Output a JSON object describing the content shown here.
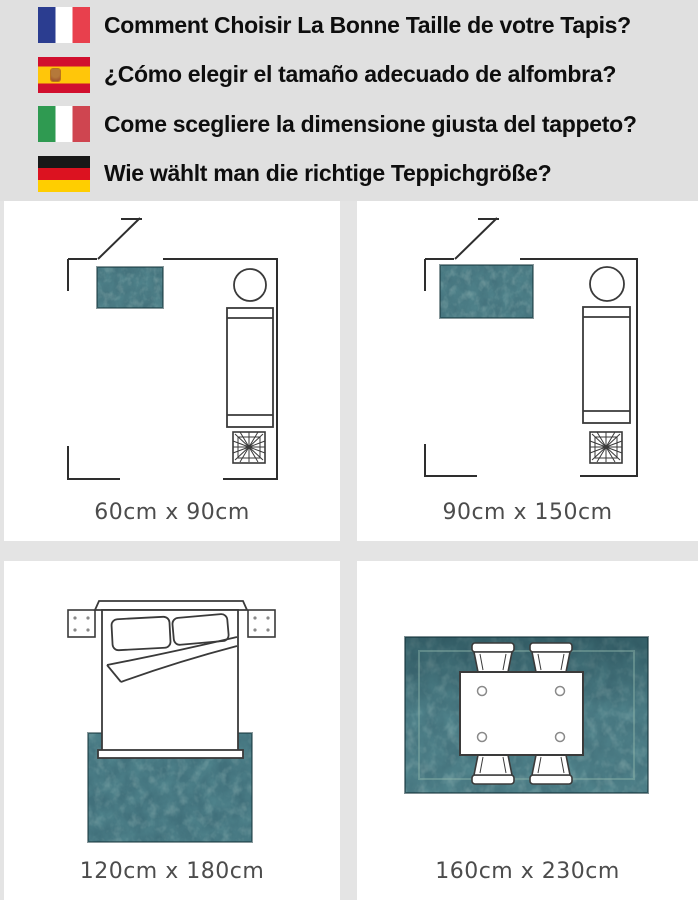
{
  "header": {
    "items": [
      {
        "flag": "france",
        "text": "Comment Choisir La Bonne Taille de votre Tapis?"
      },
      {
        "flag": "spain",
        "text": "¿Cómo elegir el tamaño adecuado de alfombra?"
      },
      {
        "flag": "italy",
        "text": "Come scegliere la dimensione giusta del tappeto?"
      },
      {
        "flag": "germany",
        "text": "Wie wählt man die richtige Teppichgröße?"
      }
    ]
  },
  "panels": [
    {
      "scene": "living-room-small-rug",
      "label": "60cm x 90cm"
    },
    {
      "scene": "living-room-medium-rug",
      "label": "90cm x 150cm"
    },
    {
      "scene": "bedroom-rug",
      "label": "120cm x 180cm"
    },
    {
      "scene": "dining-room-rug",
      "label": "160cm x 230cm"
    }
  ],
  "icons": {
    "flags": [
      "france-flag-icon",
      "spain-flag-icon",
      "italy-flag-icon",
      "germany-flag-icon"
    ],
    "scene_items": [
      "door-icon",
      "rug",
      "round-table-icon",
      "sofa-icon",
      "plant-icon",
      "bed-icon",
      "pillow-icon",
      "nightstand-icon",
      "duvet-fold",
      "dining-table-icon",
      "chair-icon"
    ]
  },
  "colors": {
    "header_bg": "#e0e0e0",
    "panel_bg": "#ffffff",
    "divider": "#e4e4e4",
    "wall_line": "#2e2e2e",
    "label_text": "#4c4c4c",
    "rug_base": "#45737d",
    "rug_dark": "#1a474f",
    "rug_light": "#8cb3a8"
  }
}
